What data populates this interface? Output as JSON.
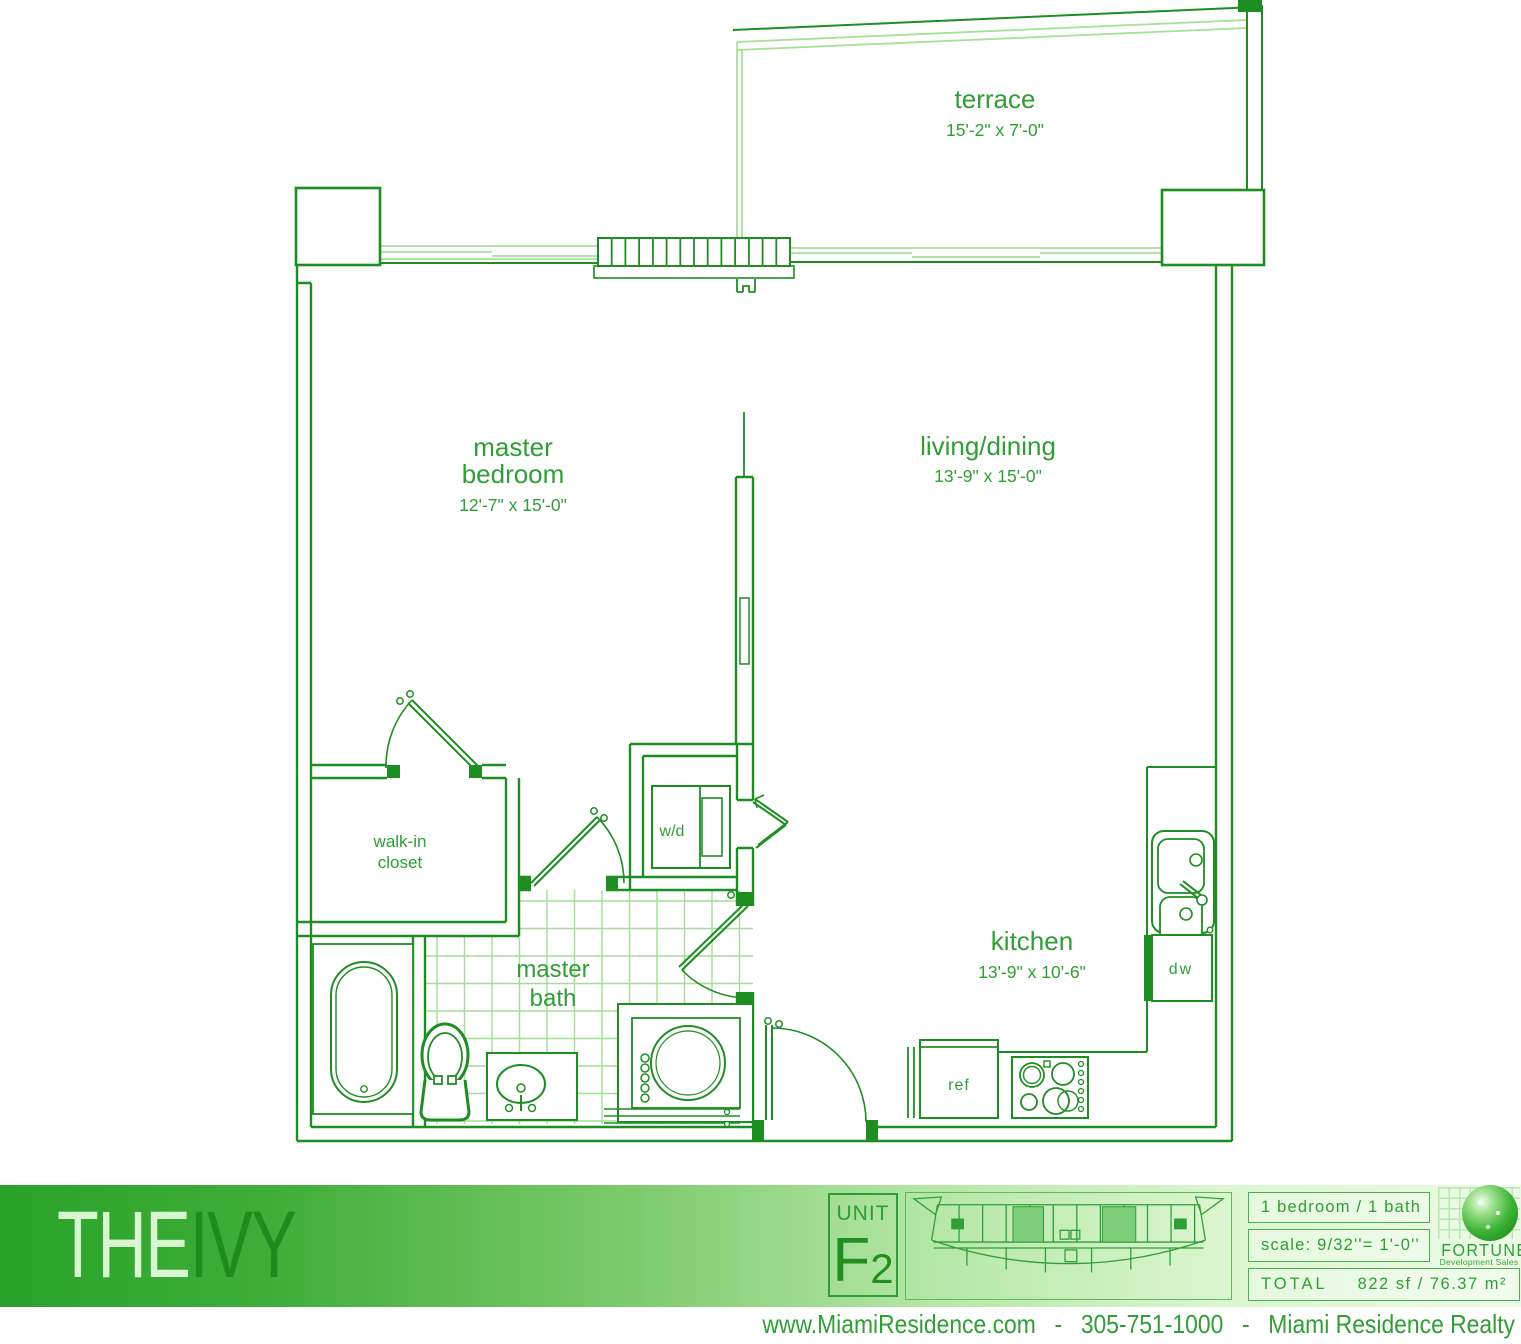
{
  "plan": {
    "rooms": {
      "terrace": {
        "name": "terrace",
        "dims": "15'-2\" x 7'-0\""
      },
      "master_bedroom": {
        "line1": "master",
        "line2": "bedroom",
        "dims": "12'-7\" x 15'-0\""
      },
      "living_dining": {
        "name": "living/dining",
        "dims": "13'-9\" x 15'-0\""
      },
      "kitchen": {
        "name": "kitchen",
        "dims": "13'-9\" x 10'-6\""
      },
      "master_bath": {
        "line1": "master",
        "line2": "bath"
      },
      "walk_in_closet": {
        "line1": "walk-in",
        "line2": "closet"
      }
    },
    "fixtures": {
      "washer_dryer": "w/d",
      "dishwasher": "dw",
      "refrigerator": "ref"
    }
  },
  "footer": {
    "brand": {
      "the": "THE",
      "ivy": "IVY"
    },
    "unit": {
      "label": "UNIT",
      "letter": "F",
      "number": "2"
    },
    "info": {
      "bed_bath": "1 bedroom / 1 bath",
      "scale": "scale: 9/32''= 1'-0''",
      "total_label": "TOTAL",
      "total_value": "822 sf / 76.37 m²"
    },
    "logo": {
      "name": "FORTUNE",
      "tagline": "Development Sales"
    },
    "contact": {
      "website": "www.MiamiResidence.com",
      "separator1": "-",
      "phone": "305-751-1000",
      "separator2": "-",
      "company": "Miami Residence Realty"
    }
  },
  "colors": {
    "wall_green": "#1e8e22",
    "label_green": "#2f9e35",
    "light_green": "#a6e19a",
    "tile_green": "#a3dd97",
    "bar_dark": "#29a229",
    "bar_light": "#ecfbe6",
    "highlight_unit": "#7fce7c"
  }
}
